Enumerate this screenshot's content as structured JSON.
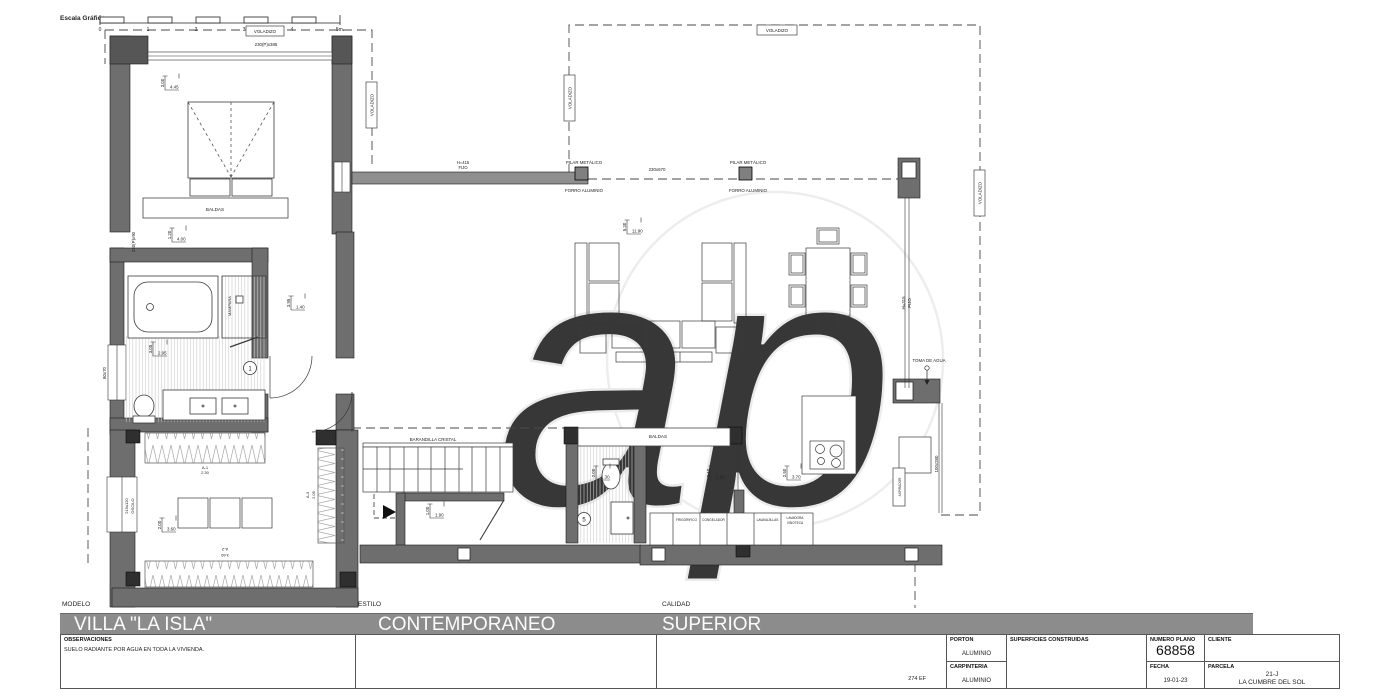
{
  "scale_bar": {
    "title": "Escala Gráfica",
    "ticks": [
      "0",
      "1",
      "2",
      "3",
      "4",
      "5m."
    ]
  },
  "watermark": "ap",
  "colors": {
    "wall": "#6e6e6e",
    "band": "#8c8c8c",
    "line": "#222222",
    "hatch": "#bbbbbb"
  },
  "plan": {
    "voladizo": "VOLADIZO",
    "pilar_metalico": "PILAR METÁLICO",
    "forro_aluminio": "FORRO ALUMINIO",
    "baldas": "BALDAS",
    "mampara": "MAMPARA",
    "barandilla": "BARANDILLA CRISTAL",
    "toma_agua": "TOMA DE AGUA",
    "aspirador": "ASPIRADOR",
    "room1": "1",
    "room5": "5",
    "windows": {
      "w230p385": "230(P)x385",
      "w230p90": "230(P)x90",
      "w80x70": "80x70",
      "w215x120": "215x120",
      "oscilo": "OSCILO",
      "w230x670": "230x670",
      "h415": "H=415",
      "h315": "H=315",
      "fijo": "FIJO",
      "w100x280": "100x280"
    },
    "wardrobes": {
      "a1": "A-1",
      "a1v": "2.30",
      "a2": "A-2",
      "a2v": "3.60",
      "a3": "A-3",
      "a3v": "2.05"
    },
    "appliances": [
      "FRIGORIFICO",
      "CONGELADOR",
      "LAVAVAJILLAS",
      "LAVADORA",
      "VINOTECA"
    ],
    "dims": {
      "bedroom": {
        "v": "3.00",
        "h": "4.45"
      },
      "bedroom2": {
        "v": "1.20",
        "h": "4.00"
      },
      "hall": {
        "v": "3.95",
        "h": "1.40"
      },
      "bath": {
        "v": "3.05",
        "h": "2.95"
      },
      "dressing": {
        "v": "2.00",
        "h": "3.60"
      },
      "understair": {
        "v": "1.00",
        "h": "1.90"
      },
      "bath5": {
        "v": "2.00",
        "h": "1.30"
      },
      "kitchen1": {
        "v": "2.10",
        "h": "2.20"
      },
      "kitchen2": {
        "v": "2.50",
        "h": "3.70"
      },
      "living": {
        "v": "5.30",
        "h": "11.90"
      }
    }
  },
  "footer": {
    "modelo_label": "MODELO",
    "modelo": "VILLA \"LA ISLA\"",
    "estilo_label": "ESTILO",
    "estilo": "CONTEMPORANEO",
    "calidad_label": "CALIDAD",
    "calidad": "SUPERIOR",
    "observaciones_label": "OBSERVACIONES",
    "observaciones": "SUELO RADIANTE POR AGUA EN TODA LA VIVIENDA.",
    "ref": "274 EF",
    "porton_label": "PORTON",
    "porton_value": "ALUMINIO",
    "carpinteria_label": "CARPINTERIA",
    "carpinteria_value": "ALUMINIO",
    "superficies_label": "SUPERFICIES CONSTRUIDAS",
    "numero_label": "NUMERO PLANO",
    "numero_value": "68858",
    "fecha_label": "FECHA",
    "fecha_value": "19-01-23",
    "cliente_label": "CLIENTE",
    "parcela_label": "PARCELA",
    "parcela_value_1": "21-J",
    "parcela_value_2": "LA CUMBRE DEL SOL"
  }
}
